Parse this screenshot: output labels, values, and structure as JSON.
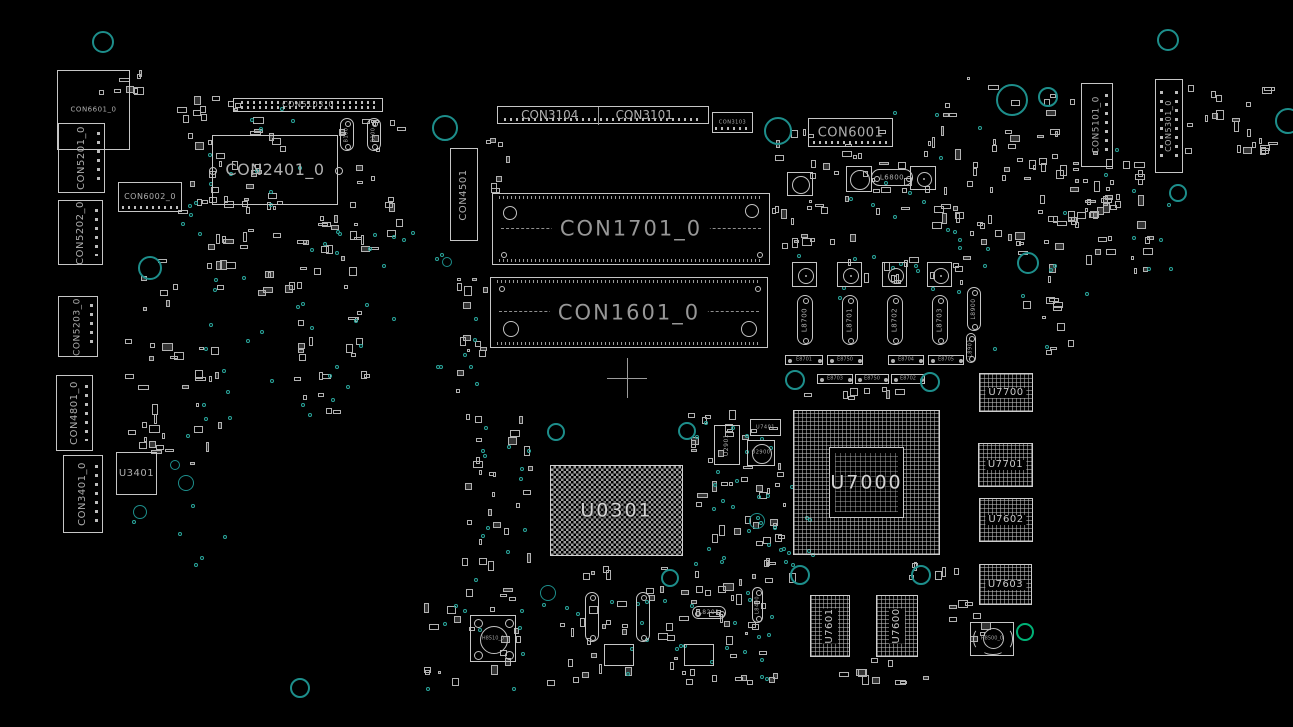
{
  "canvas": {
    "width": 1293,
    "height": 727
  },
  "colors": {
    "background": "#000000",
    "silkscreen": "#c6c6c6",
    "label_text": "#aeaeae",
    "via_teal": "#1d8e8b",
    "dot_teal": "#2aa79d",
    "highlight_green": "#00b277"
  },
  "components": [
    {
      "t": "conn",
      "l": "CON6601_0",
      "x": 57,
      "y": 70,
      "w": 73,
      "h": 80,
      "o": "h",
      "fs": 7
    },
    {
      "t": "conn",
      "l": "CON5201_0",
      "x": 58,
      "y": 123,
      "w": 47,
      "h": 70,
      "o": "v",
      "fs": 10,
      "pins": "vdots"
    },
    {
      "t": "conn",
      "l": "CON5202_0",
      "x": 58,
      "y": 200,
      "w": 45,
      "h": 65,
      "o": "v",
      "fs": 10,
      "pins": "vdots"
    },
    {
      "t": "conn",
      "l": "CON5203_0",
      "x": 58,
      "y": 296,
      "w": 40,
      "h": 61,
      "o": "v",
      "fs": 9,
      "pins": "vdots"
    },
    {
      "t": "conn",
      "l": "CON4801_0",
      "x": 56,
      "y": 375,
      "w": 37,
      "h": 76,
      "o": "v",
      "fs": 10,
      "pins": "vdots"
    },
    {
      "t": "conn",
      "l": "CON3401_0",
      "x": 63,
      "y": 455,
      "w": 40,
      "h": 78,
      "o": "v",
      "fs": 10,
      "pins": "vdots"
    },
    {
      "t": "chip",
      "l": "U3401",
      "x": 116,
      "y": 452,
      "w": 41,
      "h": 43,
      "o": "h",
      "fs": 10
    },
    {
      "t": "conn",
      "l": "CON6002_0",
      "x": 118,
      "y": 182,
      "w": 64,
      "h": 30,
      "o": "h",
      "fs": 8,
      "pins": "hdots"
    },
    {
      "t": "conn",
      "l": "CON2401_0",
      "x": 212,
      "y": 135,
      "w": 126,
      "h": 70,
      "o": "h",
      "fs": 16,
      "sc": 1
    },
    {
      "t": "conn",
      "l": "CON5103_0",
      "x": 233,
      "y": 98,
      "w": 150,
      "h": 14,
      "o": "h",
      "fs": 8,
      "pins": "hdots2"
    },
    {
      "t": "cap",
      "l": "B100",
      "x": 340,
      "y": 118,
      "w": 14,
      "h": 33,
      "o": "v",
      "fs": 5
    },
    {
      "t": "cap",
      "l": "B100",
      "x": 367,
      "y": 118,
      "w": 14,
      "h": 33,
      "o": "v",
      "fs": 5
    },
    {
      "t": "conn2",
      "l": "CON3104",
      "l2": "CON3101",
      "x": 497,
      "y": 106,
      "w": 212,
      "h": 18,
      "fs": 12
    },
    {
      "t": "conn",
      "l": "CON3103",
      "x": 712,
      "y": 112,
      "w": 41,
      "h": 21,
      "o": "h",
      "fs": 5,
      "pins": "hdots"
    },
    {
      "t": "conn",
      "l": "CON4501",
      "x": 450,
      "y": 148,
      "w": 28,
      "h": 93,
      "o": "v",
      "fs": 10
    },
    {
      "t": "slot",
      "l": "CON1701_0",
      "x": 492,
      "y": 193,
      "w": 278,
      "h": 72,
      "fs": 21,
      "big": "top"
    },
    {
      "t": "slot",
      "l": "CON1601_0",
      "x": 490,
      "y": 277,
      "w": 278,
      "h": 71,
      "fs": 21,
      "big": "bottom"
    },
    {
      "t": "cross",
      "x": 607,
      "y": 358,
      "w": 40,
      "h": 40
    },
    {
      "t": "conn",
      "l": "CON6001",
      "x": 808,
      "y": 118,
      "w": 85,
      "h": 29,
      "o": "h",
      "fs": 13,
      "pins": "hdots"
    },
    {
      "t": "cap",
      "l": "L6800",
      "x": 871,
      "y": 169,
      "w": 42,
      "h": 17,
      "o": "h",
      "fs": 7
    },
    {
      "t": "circ",
      "l": "",
      "x": 787,
      "y": 172,
      "w": 26,
      "h": 24
    },
    {
      "t": "circ",
      "l": "",
      "x": 846,
      "y": 166,
      "w": 26,
      "h": 26
    },
    {
      "t": "coil",
      "x": 910,
      "y": 166,
      "w": 26,
      "h": 24
    },
    {
      "t": "conn",
      "l": "CON5101_0",
      "x": 1081,
      "y": 83,
      "w": 32,
      "h": 84,
      "o": "v",
      "fs": 9,
      "pins": "vdots"
    },
    {
      "t": "conn",
      "l": "CON5301_0",
      "x": 1155,
      "y": 79,
      "w": 28,
      "h": 94,
      "o": "v",
      "fs": 8,
      "pins": "vdots2"
    },
    {
      "t": "coil",
      "x": 792,
      "y": 262,
      "w": 25,
      "h": 25
    },
    {
      "t": "coil",
      "x": 837,
      "y": 262,
      "w": 25,
      "h": 25
    },
    {
      "t": "coil",
      "x": 882,
      "y": 262,
      "w": 25,
      "h": 25
    },
    {
      "t": "coil",
      "x": 927,
      "y": 262,
      "w": 25,
      "h": 25
    },
    {
      "t": "cap",
      "l": "L8700",
      "x": 797,
      "y": 295,
      "w": 16,
      "h": 50,
      "o": "v",
      "fs": 7
    },
    {
      "t": "cap",
      "l": "L8701",
      "x": 842,
      "y": 295,
      "w": 16,
      "h": 50,
      "o": "v",
      "fs": 7
    },
    {
      "t": "cap",
      "l": "L8702",
      "x": 887,
      "y": 295,
      "w": 16,
      "h": 50,
      "o": "v",
      "fs": 7
    },
    {
      "t": "cap",
      "l": "L8703",
      "x": 932,
      "y": 295,
      "w": 16,
      "h": 50,
      "o": "v",
      "fs": 7
    },
    {
      "t": "cap",
      "l": "L8900",
      "x": 967,
      "y": 287,
      "w": 14,
      "h": 44,
      "o": "v",
      "fs": 6
    },
    {
      "t": "cap",
      "l": "L8901",
      "x": 966,
      "y": 333,
      "w": 10,
      "h": 30,
      "o": "v",
      "fs": 5
    },
    {
      "t": "pill",
      "l": "E8701",
      "x": 785,
      "y": 355,
      "w": 38,
      "h": 10,
      "fs": 5
    },
    {
      "t": "pill",
      "l": "E8750",
      "x": 827,
      "y": 355,
      "w": 36,
      "h": 10,
      "fs": 5
    },
    {
      "t": "pill",
      "l": "E8704",
      "x": 888,
      "y": 355,
      "w": 36,
      "h": 10,
      "fs": 5
    },
    {
      "t": "pill",
      "l": "E8705",
      "x": 928,
      "y": 355,
      "w": 36,
      "h": 10,
      "fs": 5
    },
    {
      "t": "pill",
      "l": "E8703",
      "x": 817,
      "y": 374,
      "w": 36,
      "h": 10,
      "fs": 5
    },
    {
      "t": "pill",
      "l": "E8750",
      "x": 855,
      "y": 374,
      "w": 34,
      "h": 10,
      "fs": 5
    },
    {
      "t": "pill",
      "l": "E8702",
      "x": 891,
      "y": 374,
      "w": 34,
      "h": 10,
      "fs": 5
    },
    {
      "t": "bga",
      "l": "U7700",
      "x": 979,
      "y": 373,
      "w": 54,
      "h": 39,
      "fs": 10
    },
    {
      "t": "bga",
      "l": "U7701",
      "x": 978,
      "y": 443,
      "w": 55,
      "h": 44,
      "fs": 10
    },
    {
      "t": "bga",
      "l": "U7602",
      "x": 979,
      "y": 498,
      "w": 54,
      "h": 44,
      "fs": 10
    },
    {
      "t": "bga",
      "l": "U7603",
      "x": 979,
      "y": 564,
      "w": 53,
      "h": 41,
      "fs": 10
    },
    {
      "t": "bgax",
      "l": "U7000",
      "x": 793,
      "y": 410,
      "w": 147,
      "h": 145,
      "fs": 19
    },
    {
      "t": "bgac",
      "l": "U0301",
      "x": 550,
      "y": 465,
      "w": 133,
      "h": 91,
      "fs": 19
    },
    {
      "t": "bgav",
      "l": "U7601",
      "x": 810,
      "y": 595,
      "w": 40,
      "h": 62,
      "fs": 10
    },
    {
      "t": "bgav",
      "l": "U7600",
      "x": 876,
      "y": 595,
      "w": 42,
      "h": 62,
      "fs": 10
    },
    {
      "t": "fan",
      "l": "H8510_0",
      "x": 470,
      "y": 615,
      "w": 46,
      "h": 47,
      "fs": 5
    },
    {
      "t": "mount",
      "l": "H8500_0",
      "x": 970,
      "y": 622,
      "w": 44,
      "h": 34,
      "fs": 5
    },
    {
      "t": "chip",
      "l": "U2901",
      "x": 714,
      "y": 425,
      "w": 26,
      "h": 40,
      "o": "v",
      "fs": 6
    },
    {
      "t": "chip",
      "l": "U7401",
      "x": 750,
      "y": 419,
      "w": 31,
      "h": 17,
      "o": "h",
      "fs": 5
    },
    {
      "t": "circ",
      "l": "U2900",
      "x": 747,
      "y": 440,
      "w": 28,
      "h": 26,
      "fs": 5
    },
    {
      "t": "cap",
      "l": "",
      "x": 585,
      "y": 592,
      "w": 14,
      "h": 50,
      "o": "v"
    },
    {
      "t": "cap",
      "l": "",
      "x": 636,
      "y": 592,
      "w": 14,
      "h": 50,
      "o": "v"
    },
    {
      "t": "cap",
      "l": "L8201",
      "x": 692,
      "y": 606,
      "w": 34,
      "h": 13,
      "o": "h",
      "fs": 6
    },
    {
      "t": "cap",
      "l": "L8400",
      "x": 752,
      "y": 587,
      "w": 11,
      "h": 36,
      "o": "v",
      "fs": 5
    },
    {
      "t": "chip",
      "l": "",
      "x": 604,
      "y": 644,
      "w": 30,
      "h": 22,
      "o": "h"
    },
    {
      "t": "chip",
      "l": "",
      "x": 684,
      "y": 644,
      "w": 30,
      "h": 22,
      "o": "h"
    }
  ],
  "circles": [
    {
      "x": 103,
      "y": 42,
      "r": 11
    },
    {
      "x": 445,
      "y": 128,
      "r": 13
    },
    {
      "x": 778,
      "y": 131,
      "r": 14
    },
    {
      "x": 1012,
      "y": 100,
      "r": 16
    },
    {
      "x": 1048,
      "y": 97,
      "r": 10
    },
    {
      "x": 1168,
      "y": 40,
      "r": 11
    },
    {
      "x": 1288,
      "y": 121,
      "r": 13
    },
    {
      "x": 150,
      "y": 268,
      "r": 12
    },
    {
      "x": 1028,
      "y": 263,
      "r": 11
    },
    {
      "x": 175,
      "y": 465,
      "r": 5
    },
    {
      "x": 186,
      "y": 483,
      "r": 8
    },
    {
      "x": 140,
      "y": 512,
      "r": 7
    },
    {
      "x": 556,
      "y": 432,
      "r": 9
    },
    {
      "x": 687,
      "y": 431,
      "r": 9
    },
    {
      "x": 757,
      "y": 521,
      "r": 8
    },
    {
      "x": 795,
      "y": 380,
      "r": 10
    },
    {
      "x": 930,
      "y": 382,
      "r": 10
    },
    {
      "x": 800,
      "y": 575,
      "r": 10
    },
    {
      "x": 921,
      "y": 575,
      "r": 10
    },
    {
      "x": 670,
      "y": 578,
      "r": 9
    },
    {
      "x": 548,
      "y": 593,
      "r": 8
    },
    {
      "x": 300,
      "y": 688,
      "r": 10
    },
    {
      "x": 1178,
      "y": 193,
      "r": 9
    },
    {
      "x": 447,
      "y": 262,
      "r": 5
    },
    {
      "x": 1025,
      "y": 632,
      "r": 9,
      "c": "green"
    }
  ],
  "clusters": [
    {
      "x": 95,
      "y": 58,
      "w": 55,
      "h": 55,
      "n": 8
    },
    {
      "x": 175,
      "y": 95,
      "w": 115,
      "h": 125,
      "n": 42
    },
    {
      "x": 345,
      "y": 195,
      "w": 70,
      "h": 60,
      "n": 10
    },
    {
      "x": 190,
      "y": 212,
      "w": 170,
      "h": 85,
      "n": 34
    },
    {
      "x": 122,
      "y": 252,
      "w": 110,
      "h": 215,
      "n": 40
    },
    {
      "x": 288,
      "y": 300,
      "w": 85,
      "h": 115,
      "n": 20
    },
    {
      "x": 338,
      "y": 118,
      "w": 70,
      "h": 70,
      "n": 12
    },
    {
      "x": 455,
      "y": 270,
      "w": 35,
      "h": 125,
      "n": 14
    },
    {
      "x": 480,
      "y": 128,
      "w": 35,
      "h": 70,
      "n": 7
    },
    {
      "x": 458,
      "y": 408,
      "w": 75,
      "h": 195,
      "n": 30
    },
    {
      "x": 555,
      "y": 558,
      "w": 225,
      "h": 88,
      "n": 44
    },
    {
      "x": 688,
      "y": 408,
      "w": 100,
      "h": 145,
      "n": 32
    },
    {
      "x": 772,
      "y": 128,
      "w": 225,
      "h": 122,
      "n": 56
    },
    {
      "x": 940,
      "y": 75,
      "w": 140,
      "h": 188,
      "n": 52
    },
    {
      "x": 1035,
      "y": 150,
      "w": 120,
      "h": 138,
      "n": 34
    },
    {
      "x": 1062,
      "y": 172,
      "w": 55,
      "h": 50,
      "n": 14
    },
    {
      "x": 1185,
      "y": 85,
      "w": 95,
      "h": 85,
      "n": 22
    },
    {
      "x": 420,
      "y": 598,
      "w": 110,
      "h": 90,
      "n": 16
    },
    {
      "x": 540,
      "y": 648,
      "w": 240,
      "h": 38,
      "n": 20
    },
    {
      "x": 830,
      "y": 658,
      "w": 130,
      "h": 28,
      "n": 10
    },
    {
      "x": 940,
      "y": 600,
      "w": 55,
      "h": 45,
      "n": 8
    },
    {
      "x": 790,
      "y": 386,
      "w": 150,
      "h": 16,
      "n": 8
    },
    {
      "x": 760,
      "y": 558,
      "w": 45,
      "h": 30,
      "n": 5
    },
    {
      "x": 900,
      "y": 560,
      "w": 60,
      "h": 25,
      "n": 6
    },
    {
      "x": 755,
      "y": 470,
      "w": 32,
      "h": 85,
      "n": 8
    },
    {
      "x": 1020,
      "y": 290,
      "w": 60,
      "h": 75,
      "n": 10
    },
    {
      "x": 815,
      "y": 255,
      "w": 150,
      "h": 38,
      "n": 12
    }
  ],
  "dot_clusters": [
    {
      "x": 295,
      "y": 225,
      "w": 120,
      "h": 95,
      "n": 16
    },
    {
      "x": 185,
      "y": 275,
      "w": 90,
      "h": 170,
      "n": 14
    },
    {
      "x": 430,
      "y": 245,
      "w": 45,
      "h": 150,
      "n": 9
    },
    {
      "x": 470,
      "y": 415,
      "w": 70,
      "h": 165,
      "n": 12
    },
    {
      "x": 550,
      "y": 555,
      "w": 230,
      "h": 100,
      "n": 18
    },
    {
      "x": 690,
      "y": 415,
      "w": 105,
      "h": 150,
      "n": 26
    },
    {
      "x": 755,
      "y": 510,
      "w": 60,
      "h": 70,
      "n": 8
    },
    {
      "x": 845,
      "y": 105,
      "w": 160,
      "h": 130,
      "n": 12
    },
    {
      "x": 955,
      "y": 225,
      "w": 130,
      "h": 130,
      "n": 10
    },
    {
      "x": 1040,
      "y": 145,
      "w": 130,
      "h": 130,
      "n": 10
    },
    {
      "x": 115,
      "y": 495,
      "w": 110,
      "h": 70,
      "n": 6
    },
    {
      "x": 190,
      "y": 95,
      "w": 110,
      "h": 115,
      "n": 10
    },
    {
      "x": 425,
      "y": 595,
      "w": 120,
      "h": 95,
      "n": 10
    },
    {
      "x": 620,
      "y": 620,
      "w": 160,
      "h": 60,
      "n": 8
    },
    {
      "x": 790,
      "y": 252,
      "w": 160,
      "h": 45,
      "n": 10
    },
    {
      "x": 170,
      "y": 180,
      "w": 60,
      "h": 60,
      "n": 6
    },
    {
      "x": 300,
      "y": 320,
      "w": 60,
      "h": 100,
      "n": 8
    }
  ]
}
